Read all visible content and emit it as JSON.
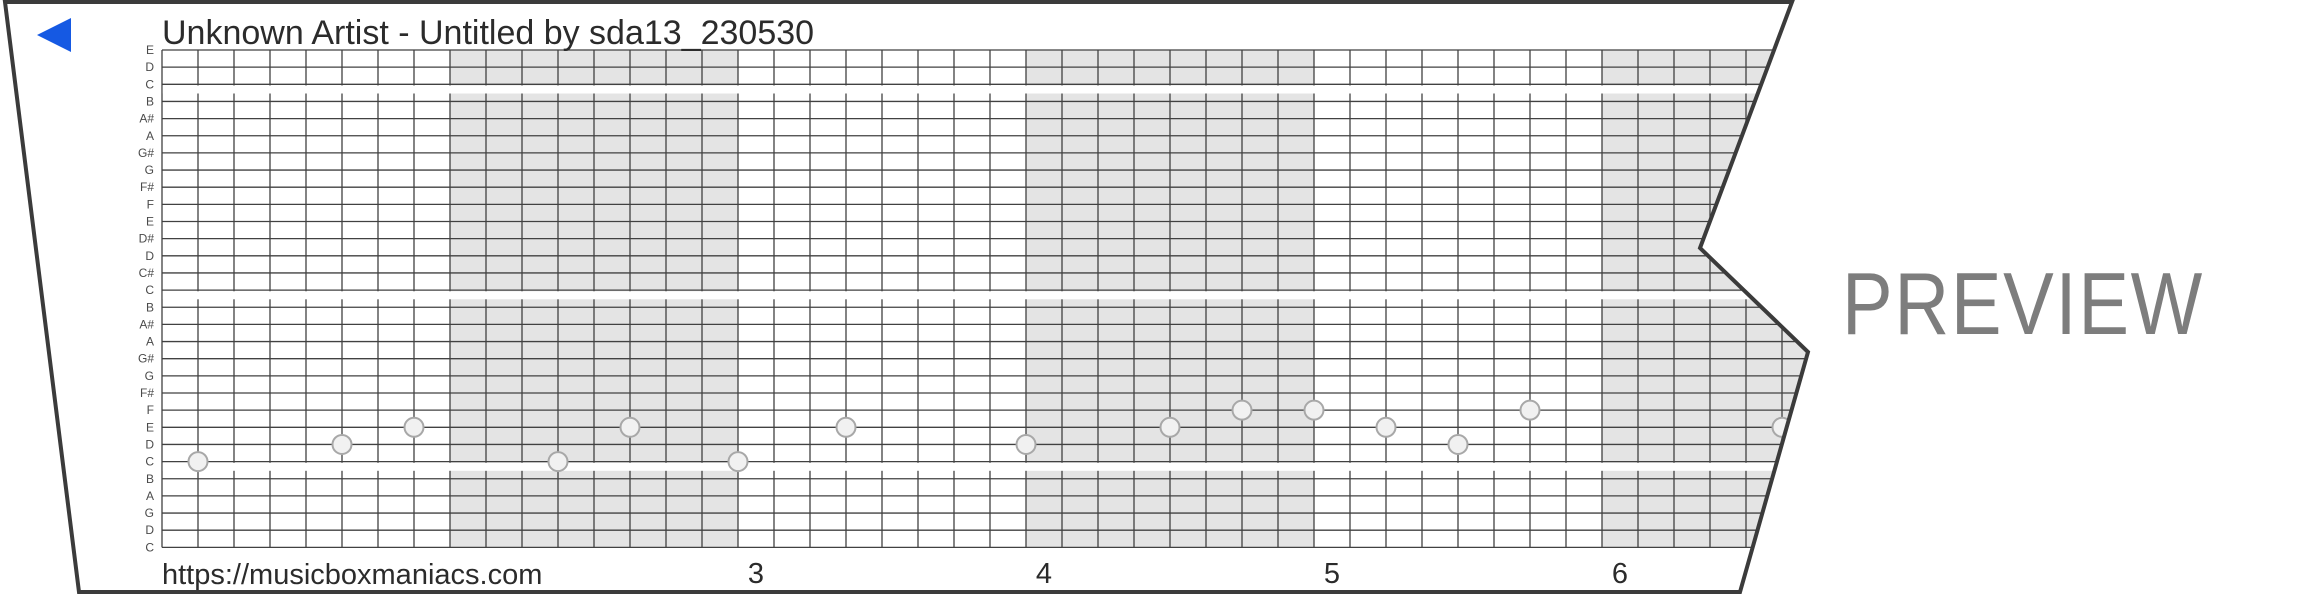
{
  "header": {
    "title": "Unknown Artist - Untitled by sda13_230530"
  },
  "watermark": "PREVIEW",
  "footer": {
    "url": "https://musicboxmaniacs.com",
    "measure_numbers": [
      "3",
      "4",
      "5",
      "6"
    ]
  },
  "chart_data": {
    "type": "music-box-strip-piano-roll",
    "title": "Unknown Artist - Untitled by sda13_230530",
    "note_lines_top_to_bottom": [
      "E",
      "D",
      "C",
      "B",
      "A#",
      "A",
      "G#",
      "G",
      "F#",
      "F",
      "E",
      "D#",
      "D",
      "C#",
      "C",
      "B",
      "A#",
      "A",
      "G#",
      "G",
      "F#",
      "F",
      "E",
      "D",
      "C",
      "B",
      "A",
      "G",
      "D",
      "C"
    ],
    "octave_gap_after_line_indexes": [
      2,
      14,
      24
    ],
    "cells_per_measure": 8,
    "visible_measure_labels": [
      "3",
      "4",
      "5",
      "6"
    ],
    "shading": "alternate measures shaded gray",
    "notes": [
      {
        "cell": 1,
        "line": 24,
        "pitch": "C"
      },
      {
        "cell": 5,
        "line": 23,
        "pitch": "D"
      },
      {
        "cell": 7,
        "line": 22,
        "pitch": "E"
      },
      {
        "cell": 11,
        "line": 24,
        "pitch": "C"
      },
      {
        "cell": 13,
        "line": 22,
        "pitch": "E"
      },
      {
        "cell": 16,
        "line": 24,
        "pitch": "C"
      },
      {
        "cell": 19,
        "line": 22,
        "pitch": "E"
      },
      {
        "cell": 24,
        "line": 23,
        "pitch": "D"
      },
      {
        "cell": 28,
        "line": 22,
        "pitch": "E"
      },
      {
        "cell": 30,
        "line": 21,
        "pitch": "F"
      },
      {
        "cell": 32,
        "line": 21,
        "pitch": "F"
      },
      {
        "cell": 34,
        "line": 22,
        "pitch": "E"
      },
      {
        "cell": 36,
        "line": 23,
        "pitch": "D"
      },
      {
        "cell": 38,
        "line": 21,
        "pitch": "F"
      },
      {
        "cell": 45,
        "line": 22,
        "pitch": "E"
      }
    ]
  },
  "colors": {
    "grid_line": "#414141",
    "measure_shade": "#e4e4e4",
    "note_fill": "#f1f1f1",
    "note_stroke": "#a8a8a8",
    "strip_border": "#3b3b3b",
    "paper": "#ffffff",
    "text": "#2b2b2b",
    "note_label": "#4a4a4a",
    "watermark": "#7d7d7d",
    "accent_blue": "#1559e3"
  }
}
